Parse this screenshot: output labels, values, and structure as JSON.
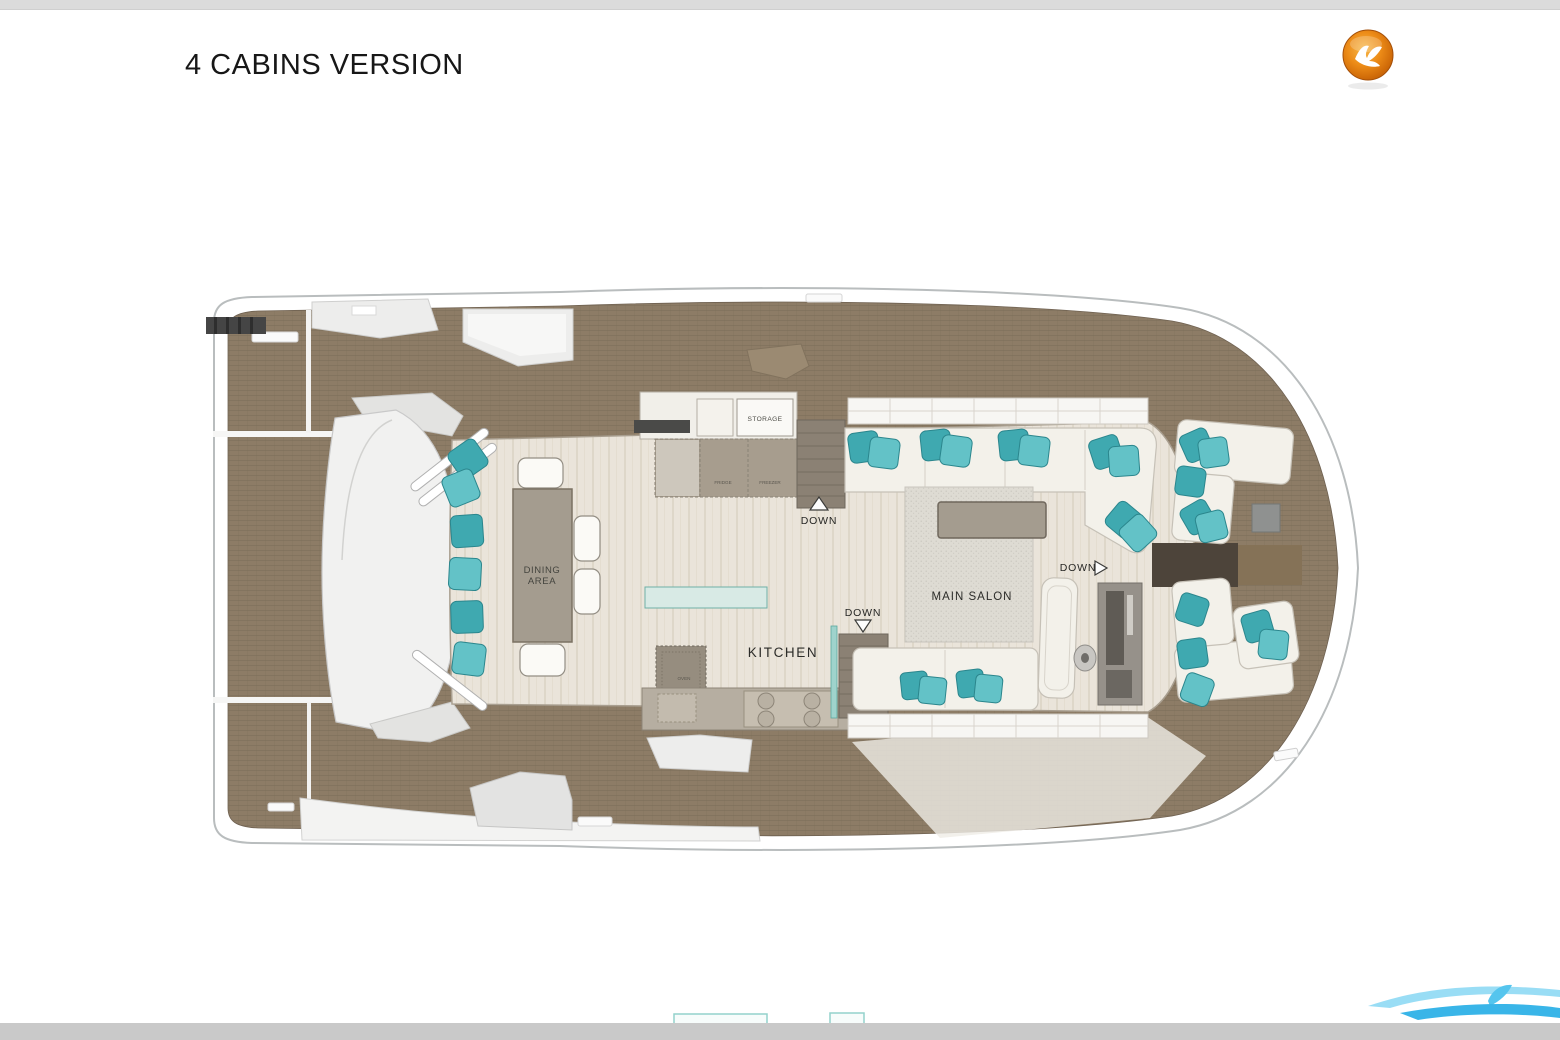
{
  "page": {
    "title": "4 CABINS VERSION",
    "background": "#ffffff",
    "top_bar_color": "#dbdbdb",
    "bottom_bar_color": "#c9c9c9"
  },
  "branding": {
    "logo": {
      "name": "bird-logo",
      "outer_color": "#b35708",
      "mid_color": "#ec8b17",
      "inner_color": "#f7b84a",
      "glyph_color": "#ffffff"
    },
    "watermark": {
      "name": "wave-watermark",
      "color_light": "#8ed9f4",
      "color_dark": "#39b5e8"
    }
  },
  "plan": {
    "name": "main-deck-floor-plan",
    "labels": {
      "dining_line1": "DINING",
      "dining_line2": "AREA",
      "kitchen": "KITCHEN",
      "main_salon": "MAIN SALON",
      "storage": "STORAGE",
      "fridge": "FRIDGE",
      "freezer": "FREEZER",
      "oven": "OVEN",
      "down": "DOWN"
    },
    "colors": {
      "teak": "#8d7c66",
      "teak_line": "#7a6b57",
      "hull": "#ffffff",
      "hull_stroke": "#b9bdbe",
      "floor": "#eae4da",
      "furniture": "#f3f1ea",
      "cushion": "#3fa9b0",
      "cushion_light": "#63c2c7",
      "counter": "#a79d8e",
      "stairs": "#8b8174",
      "rug": "#dedbd3",
      "table": "#a49c8f"
    }
  },
  "bottom_preview": {
    "name": "lower-deck-preview"
  }
}
